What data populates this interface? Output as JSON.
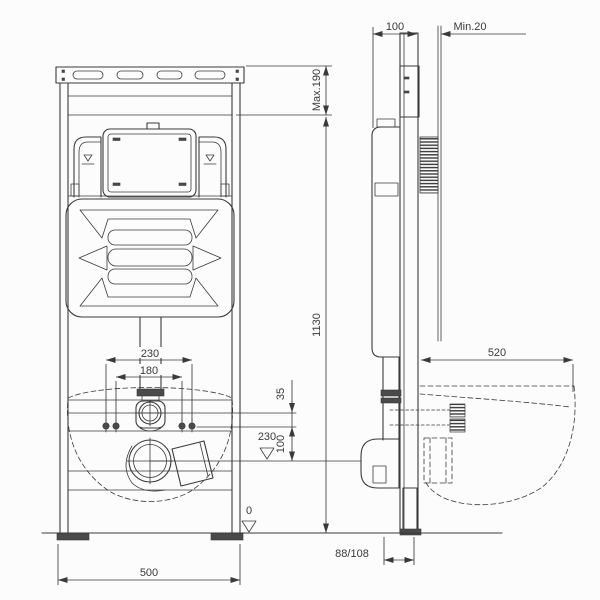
{
  "colors": {
    "line": "#3a3a3a",
    "background": "#fcfcfc"
  },
  "dimensions": {
    "frame_depth": "100",
    "min_clearance": "Min.20",
    "max_top_adjustment": "Max.190",
    "frame_height": "1130",
    "bowl_depth": "520",
    "outer_fixing_width": "230",
    "inner_fixing_width": "180",
    "inlet_drop": "35",
    "inlet_to_outlet_drop": "100",
    "outlet_height_level": "230",
    "floor_level": "0",
    "outlet_wall_offset": "88/108",
    "frame_width": "500"
  }
}
